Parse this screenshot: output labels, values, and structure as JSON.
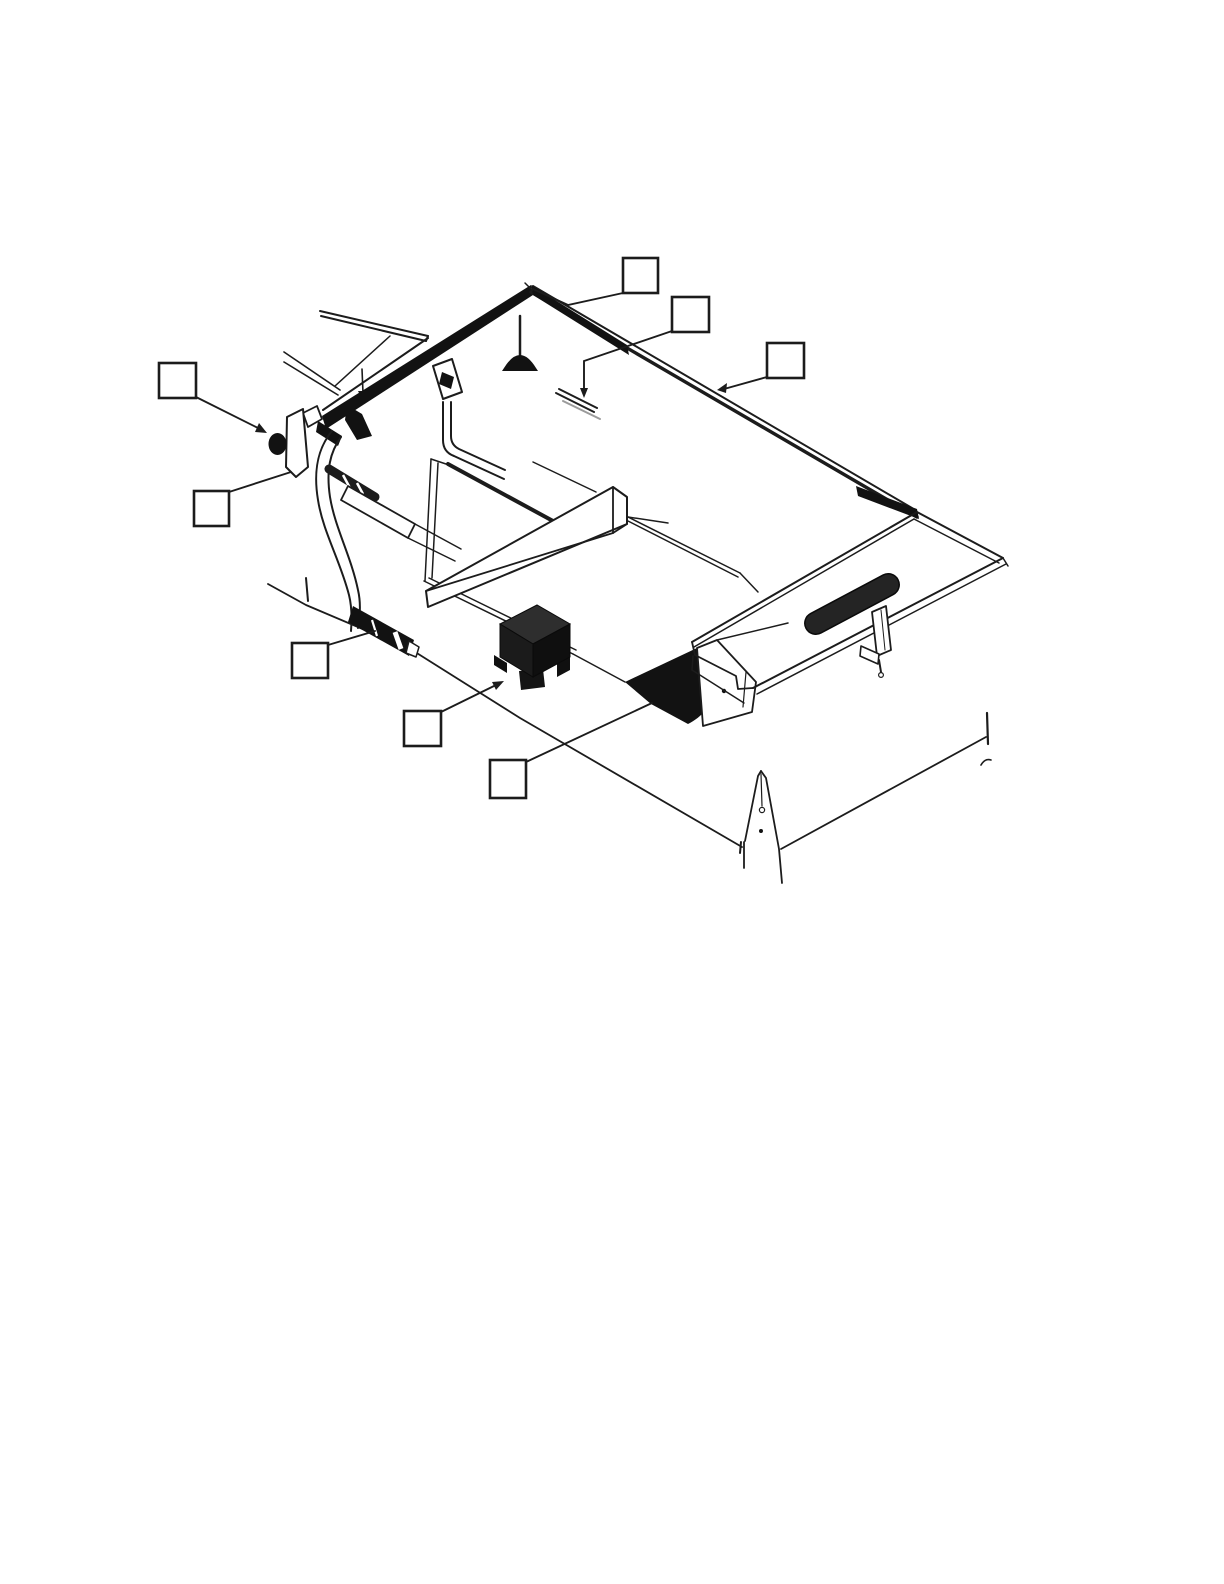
{
  "page": {
    "background_color": "#ffffff",
    "ink_color": "#1c1c1c",
    "kind": "scanned technical-manual figure, isometric exploded parts view, no visible text"
  },
  "figure": {
    "parts": [
      "roof-rail",
      "rail-end-cap",
      "mushroom-bumper",
      "strike-plate",
      "frame-strips",
      "buckle-fitting",
      "j-tube",
      "side-bracket-plate",
      "knob-ball",
      "curved-arm",
      "footwell-recess",
      "cross-beam-board",
      "side-plank",
      "hatched-bar",
      "floor-outline",
      "rocker-sill",
      "junction-box",
      "fender-wedge",
      "wedge-bracket",
      "tray-rail",
      "tray-slot",
      "clamp",
      "fork-pointer"
    ]
  },
  "callouts": [
    {
      "id": "callout-1",
      "label": ""
    },
    {
      "id": "callout-2",
      "label": ""
    },
    {
      "id": "callout-3",
      "label": ""
    },
    {
      "id": "callout-4",
      "label": ""
    },
    {
      "id": "callout-5",
      "label": ""
    },
    {
      "id": "callout-6",
      "label": ""
    },
    {
      "id": "callout-7",
      "label": ""
    },
    {
      "id": "callout-8",
      "label": ""
    }
  ]
}
